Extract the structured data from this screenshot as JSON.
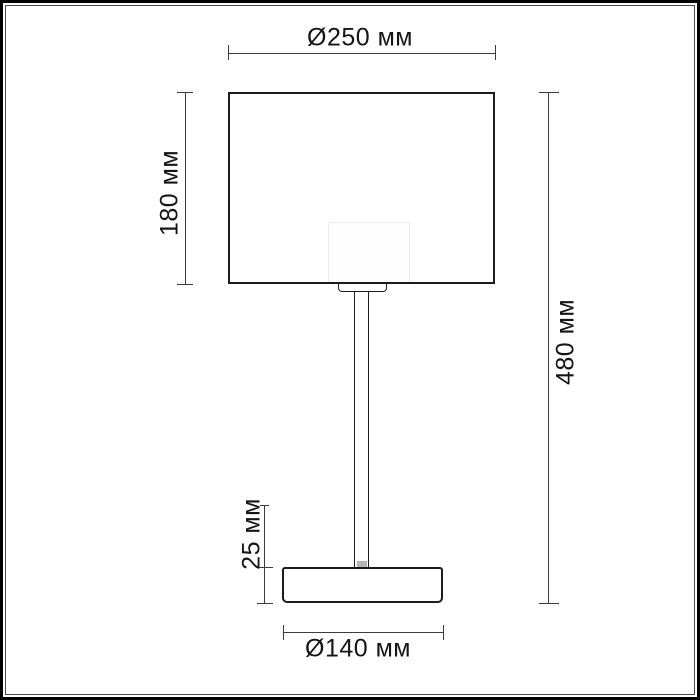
{
  "diagram": {
    "type": "technical-drawing",
    "subject": "table lamp front elevation with dimensions",
    "units": "мм",
    "dimensions": {
      "shade_diameter": {
        "label": "Ø250 мм",
        "value": 250
      },
      "shade_height": {
        "label": "180 мм",
        "value": 180
      },
      "total_height": {
        "label": "480 мм",
        "value": 480
      },
      "base_height": {
        "label": "25 мм",
        "value": 25
      },
      "base_diameter": {
        "label": "Ø140 мм",
        "value": 140
      }
    },
    "colors": {
      "outline": "#1c1c1c",
      "dimension_line": "#3c3c3c",
      "label_text": "#151515",
      "background": "#ffffff",
      "frame": "#000000",
      "socket_glow": "#ececec"
    }
  }
}
